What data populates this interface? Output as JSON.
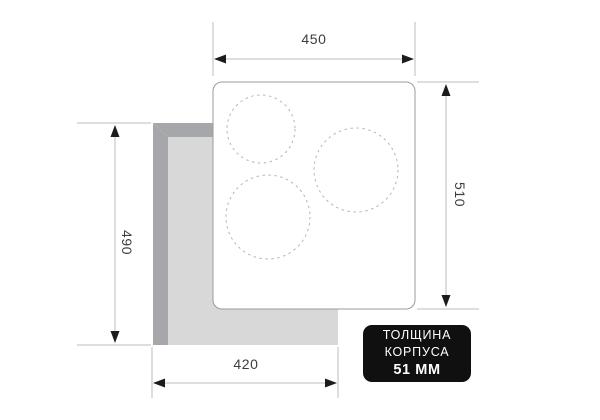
{
  "dimensions": {
    "top_width": {
      "value": "450"
    },
    "right_height": {
      "value": "510"
    },
    "left_height": {
      "value": "490"
    },
    "bottom_width": {
      "value": "420"
    }
  },
  "badge": {
    "line1": "ТОЛЩИНА",
    "line2": "КОРПУСА",
    "line3": "51 ММ"
  },
  "burners": {
    "count": 3
  },
  "colors": {
    "background": "#ffffff",
    "countertop_light": "#d8d8d8",
    "countertop_dark": "#a6a7ab",
    "panel_fill": "#ffffff",
    "panel_border": "#9b9b9b",
    "burner_dash": "#b5b5b5",
    "dimension_line": "#bdbdbd",
    "arrowhead": "#1c1c1c",
    "dimension_text": "#3d3d3d",
    "badge_bg": "#101010",
    "badge_text": "#ffffff"
  }
}
